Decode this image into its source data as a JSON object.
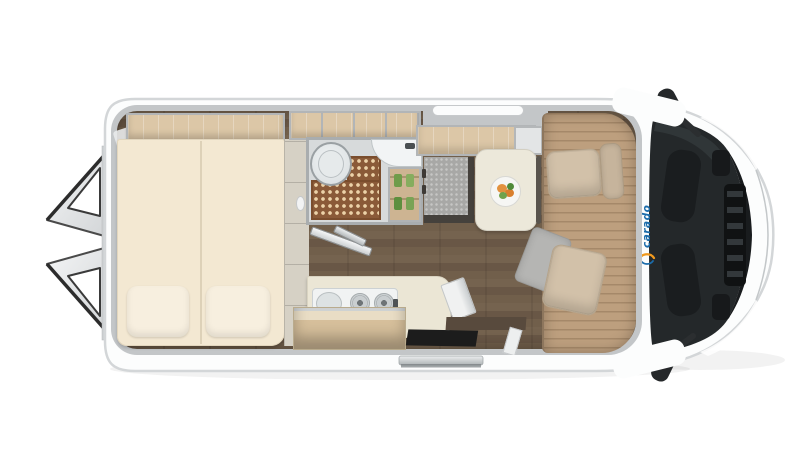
{
  "brand": {
    "logo_text": "carado"
  },
  "objects": {
    "vehicle": "camper van top-view floor plan",
    "rear_doors": "open rear doors",
    "roof_shelf": "overhead shelf above bed",
    "bed": "transverse double bed with two pillows",
    "wardrobe_column": "cabinet column beside bed",
    "bathroom": "bathroom compartment",
    "toilet": "toilet",
    "shower_tray": "shower drain mat",
    "washbasin": "corner washbasin",
    "bathroom_shelf": "bathroom shelf with bottles",
    "bathroom_door": "open bathroom door",
    "kitchen_counter": "kitchen counter",
    "cooker_sink_unit": "combined sink and two-burner hob",
    "kitchen_faucet": "kitchen faucet",
    "open_shelf": "open wooden shelf",
    "overhead_locker": "overhead locker above dinette",
    "roof_window": "roof window strip",
    "side_bench": "side bench block",
    "dining_table": "dining table",
    "plate": "plate of food",
    "cab_floor": "cab floor mat",
    "driver_seat": "swivelled driver seat",
    "passenger_seat": "swivelled passenger seat",
    "windshield": "windshield and cab",
    "front_grille": "engine hood grille",
    "mirror_top": "side mirror (left)",
    "mirror_bottom": "side mirror (right)",
    "entry_step": "entrance step",
    "slide_rail": "sliding door rail"
  },
  "colors": {
    "brand_blue": "#1b6cab",
    "brand_orange": "#f0991e",
    "body_white": "#fcfdfd",
    "body_outline": "#d3d6d8",
    "wall_gray": "#c3c6c8",
    "wood_light": "#dcc7a7",
    "floor_dark": "#6e5c4b",
    "cab_floor_wood": "#bd9f7e",
    "mattress_cream": "#f3e8d2",
    "shower_mat_brown": "#8a5a38",
    "glass_dark": "#24282a",
    "seat_beige": "#d2c1a9"
  }
}
